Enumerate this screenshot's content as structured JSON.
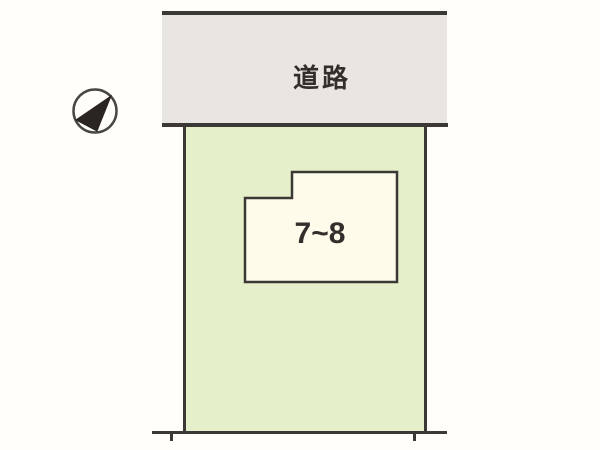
{
  "road": {
    "label": "道路"
  },
  "building": {
    "label": "7~8"
  },
  "icons": {
    "compass": "north-arrow"
  },
  "colors": {
    "background": "#fffefb",
    "road_fill": "#e9e5e2",
    "plot_fill": "#e5f0ca",
    "building_fill": "#fdfbe9",
    "line": "#3b3835",
    "text": "#332e2b"
  }
}
